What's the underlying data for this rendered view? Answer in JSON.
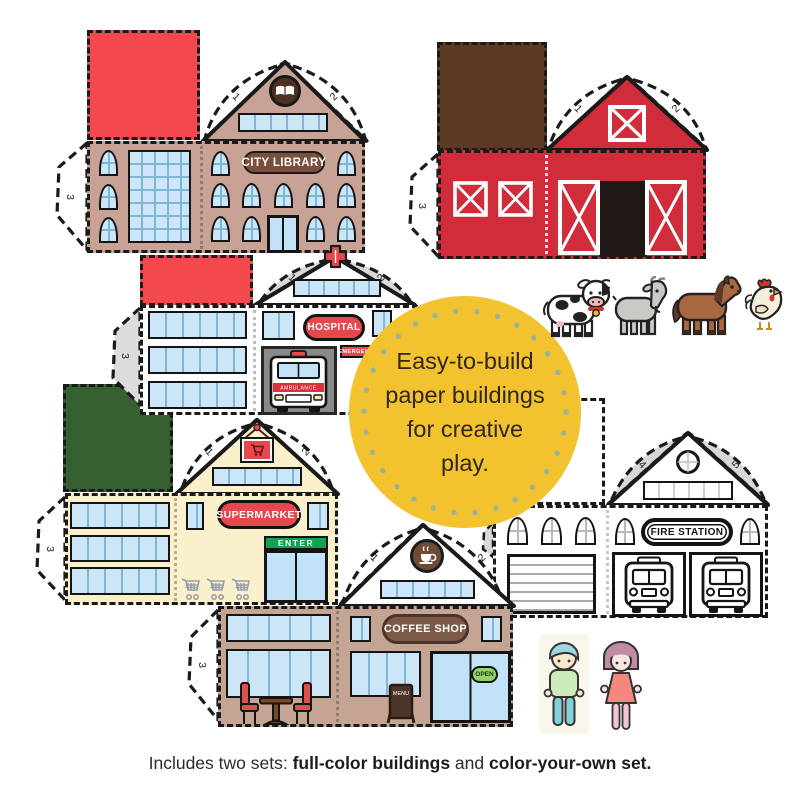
{
  "badge": {
    "lines": [
      "Easy-to-build",
      "paper buildings",
      "for creative",
      "play."
    ]
  },
  "caption": {
    "prefix": "Includes two sets: ",
    "bold_1": "full-color buildings",
    "joiner": " and ",
    "bold_2": "color-your-own set."
  },
  "buildings": {
    "library": {
      "sign": "CITY LIBRARY",
      "flap_1": "1",
      "flap_2": "2",
      "flap_3": "3"
    },
    "barn": {
      "flap_1": "1",
      "flap_2": "2",
      "flap_3": "3"
    },
    "hospital": {
      "sign": "HOSPITAL",
      "emergency": "EMERGENCY",
      "ambulance": "AMBULANCE",
      "flap_1": "1",
      "flap_2": "2",
      "flap_3": "3"
    },
    "supermarket": {
      "sign": "SUPERMARKET",
      "enter": "ENTER",
      "flap_1": "1",
      "flap_2": "2",
      "flap_3": "3"
    },
    "coffee_shop": {
      "sign": "COFFEE SHOP",
      "open": "OPEN",
      "menu": "MENU",
      "flap_1": "1",
      "flap_2": "2",
      "flap_3": "3"
    },
    "fire_station": {
      "sign": "FIRE STATION",
      "flap_4": "4",
      "flap_5": "5"
    }
  },
  "icons": {
    "library_logo": "open-book",
    "hospital_logo": "medical-cross",
    "supermarket_logo": "shopping-cart",
    "coffee_logo": "coffee-cup",
    "farm_animals": [
      "cow",
      "goat",
      "horse",
      "chicken"
    ],
    "people": [
      "boy",
      "girl"
    ]
  },
  "colors": {
    "flap_red": "#F2484E",
    "barn_red": "#D02C3A",
    "roof_brown": "#5A3A22",
    "library_tan": "#C8A294",
    "coffee_tan": "#C4A492",
    "supermarket_cream": "#FAF0CB",
    "flap_green": "#35602F",
    "enter_green": "#0CA44E",
    "window_blue": "#CCE6F8",
    "badge_yellow": "#F2C22F",
    "badge_dots": "#96B49B",
    "sign_brown": "#7B4F3B"
  }
}
